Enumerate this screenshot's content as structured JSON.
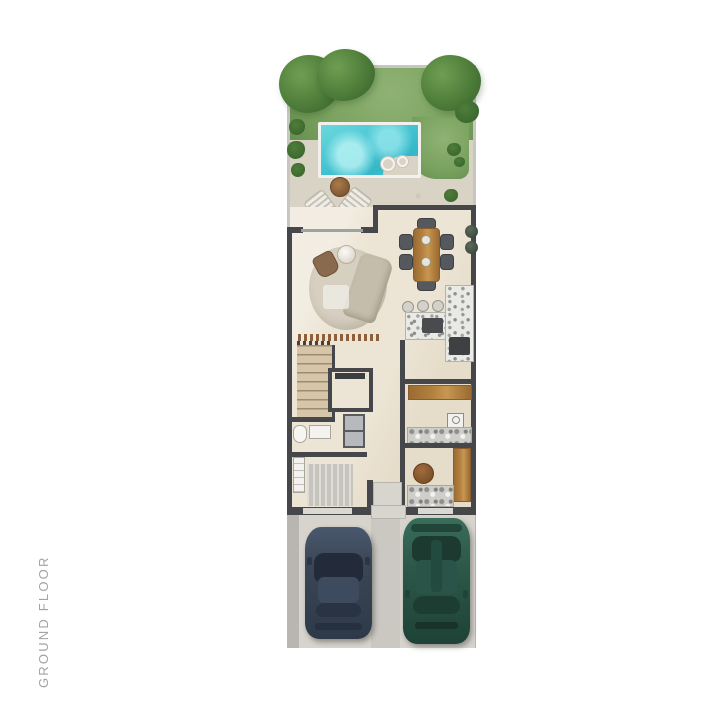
{
  "label": {
    "text": "GROUND FLOOR"
  },
  "colors": {
    "labelColor": "#a3a3a3",
    "grass": "#7aa25f",
    "grassLight": "#8fb274",
    "grassDark": "#688f50",
    "tree": "#4e7d3a",
    "treeLight": "#6f9e52",
    "treeDark": "#3a652d",
    "pool": "#45c4d2",
    "deck": "#d8d3c5",
    "floor": "#ece4d4",
    "wall": "#46474b",
    "wallLight": "#c7c6c0",
    "wood": "#b5823f",
    "woodDark": "#9a6b33",
    "sofa": "#d7d0c0",
    "sofaDark": "#c5bdac",
    "leather": "#8a6a4e",
    "chair": "#55585c",
    "terrazzo": "#e9e9e5",
    "stairsCol": "#d6c5a8",
    "concrete": "#b9b6b1",
    "concreteLight": "#d7d4cd",
    "carNavy": "#3a4655",
    "carGreen": "#2d5a4a"
  },
  "plan": {
    "features": [
      "garden-trees",
      "lawn",
      "swimming-pool",
      "spa-jets",
      "patio-table",
      "sun-loungers",
      "sliding-glass-door",
      "sofa",
      "chaise",
      "coffee-table",
      "armchair",
      "dining-table",
      "dining-chairs",
      "kitchen-island",
      "bar-stools",
      "cooktop",
      "kitchen-counter",
      "oven",
      "tv-slat-wall",
      "staircase",
      "elevator",
      "toilet",
      "sink",
      "storage-cabinet",
      "shelf",
      "laundry-counter",
      "washer",
      "powder-basin",
      "wood-partition",
      "entrance-step",
      "garage-doors",
      "driveway",
      "car-left-navy",
      "car-right-green"
    ]
  }
}
